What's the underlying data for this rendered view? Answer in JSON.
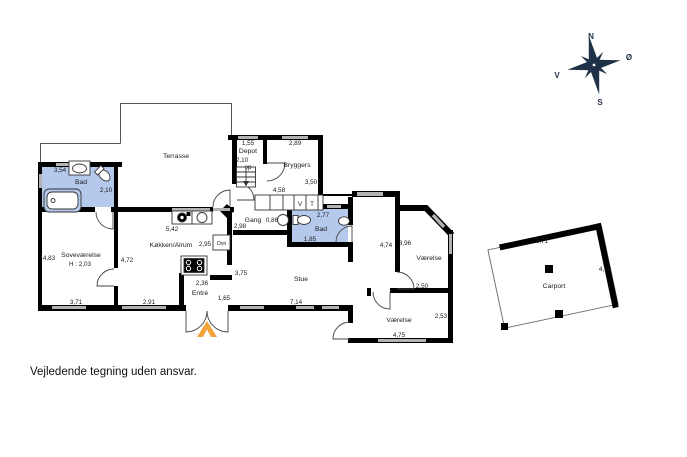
{
  "disclaimer": "Vejledende tegning uden ansvar.",
  "colors": {
    "wall": "#000000",
    "window": "#b3b3b3",
    "bath_floor": "#b5c9ec",
    "entry_arrow": "#f2a33b",
    "compass": "#1f3147"
  },
  "compass": {
    "north": "N",
    "east": "Ø",
    "south": "S",
    "west": "V"
  },
  "rooms": {
    "terrasse": {
      "label": "Terrasse"
    },
    "bad1": {
      "label": "Bad",
      "width": "3,54",
      "height": "2,10"
    },
    "sovevaerelse": {
      "label": "Soveværelse",
      "ceiling": "H : 2,03",
      "left": "4,83",
      "right": "4,72",
      "bottom": "3,71"
    },
    "koekken": {
      "label": "Køkken/Alrum",
      "top": "5,42",
      "mid": "2,95",
      "bottom": "2,91",
      "stove": "2,36",
      "oven": "Ovn"
    },
    "entre": {
      "label": "Entré",
      "width": "1,65"
    },
    "depot": {
      "label": "Depot",
      "width": "1,55",
      "depth": "2,10",
      "stairs": "op"
    },
    "bryggers": {
      "label": "Bryggers",
      "width": "2,89",
      "height": "3,50",
      "washer": "V",
      "dryer": "T"
    },
    "gang": {
      "label": "Gang",
      "width": "0,86",
      "length": "4,58",
      "left": "2,98"
    },
    "bad2": {
      "label": "Bad",
      "width": "2,77",
      "inner": "1,85"
    },
    "stue": {
      "label": "Stue",
      "width": "7,14",
      "height": "4,74",
      "left": "3,75"
    },
    "vaerelse1": {
      "label": "Værelse",
      "height": "3,96",
      "bottom": "2,50"
    },
    "vaerelse2": {
      "label": "Værelse",
      "width": "4,75",
      "height": "2,53"
    },
    "carport": {
      "label": "Carport",
      "width": "5,71",
      "height": "4,19"
    }
  }
}
